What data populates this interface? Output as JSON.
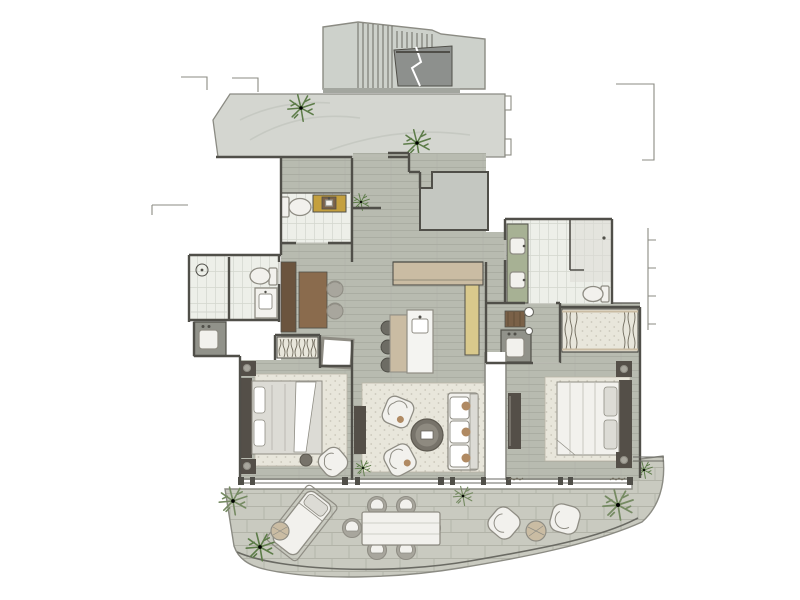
{
  "palette": {
    "paper": "#ffffff",
    "wall": "#504f49",
    "wall_light": "#8b8b83",
    "lintel": "#bdbdb5",
    "corridor": "#d4d6d0",
    "corridor_line": "#c2c5be",
    "stair": "#cdd1cb",
    "landing": "#8d908d",
    "utility": "#c4c7c1",
    "wood_floor": "#b8bbb0",
    "wood_line": "#a6a99e",
    "tile": "#edefe9",
    "tile_line": "#d3d6ce",
    "paver": "#c9cac0",
    "paver_line": "#b2b3a8",
    "rug": "#e8e6db",
    "rug_dot": "#b9b6a7",
    "marble": "#f4f4f1",
    "oak": "#cabca3",
    "vanity_yellow": "#c4a03e",
    "cabinet_yellow": "#d9c98c",
    "vanity_green": "#a7b194",
    "wood_dark": "#6b543e",
    "wood_mid": "#8a6b4d",
    "cab_brown": "#7a6148",
    "furn_white": "#f2f1ed",
    "furn_gray": "#a8a69d",
    "furn_stroke": "#8f8d84",
    "counter_gray": "#91928a",
    "headboard": "#544f48",
    "bed_gray": "#dcdbd5",
    "pillow_tan": "#b08a63",
    "plant": "#5d7c49",
    "plant_gray": "#768b63",
    "squiggle": "#6f6a5c",
    "glass": "#6a6a63",
    "shadow": "#a3a69f"
  },
  "scene": {
    "type": "residential-floor-plan-rendering",
    "rooms": [
      {
        "name": "stairwell",
        "features": [
          "stair-treads",
          "landing",
          "break-line"
        ]
      },
      {
        "name": "access-corridor",
        "features": [
          "stone-floor",
          "two-plants"
        ]
      },
      {
        "name": "entry-hall",
        "features": [
          "wood-floor",
          "plant"
        ]
      },
      {
        "name": "powder-room",
        "features": [
          "toilet",
          "yellow-vanity"
        ]
      },
      {
        "name": "utility-room",
        "features": []
      },
      {
        "name": "guest-bathroom",
        "features": [
          "shower",
          "toilet",
          "vanity",
          "washbasin-nook"
        ]
      },
      {
        "name": "study-nook",
        "features": [
          "console",
          "desk",
          "two-chairs"
        ]
      },
      {
        "name": "kitchen",
        "features": [
          "counter",
          "marble-island",
          "sink",
          "three-stools",
          "tall-yellow-cabinet"
        ]
      },
      {
        "name": "living-room",
        "features": [
          "rug",
          "sofa",
          "two-armchairs",
          "coffee-table",
          "tv-console",
          "plant"
        ]
      },
      {
        "name": "bedroom-left",
        "features": [
          "bed",
          "nightstands",
          "rug",
          "armchair",
          "stool",
          "closet",
          "bench"
        ]
      },
      {
        "name": "master-bathroom",
        "features": [
          "double-green-vanity",
          "walk-in-shower",
          "toilet"
        ]
      },
      {
        "name": "master-vestibule",
        "features": [
          "cabinet",
          "washbasin",
          "door-pivots"
        ]
      },
      {
        "name": "wardrobe",
        "features": [
          "hanging-rails"
        ]
      },
      {
        "name": "bedroom-right",
        "features": [
          "bed",
          "nightstands",
          "rug",
          "tv-console"
        ]
      },
      {
        "name": "terrace",
        "features": [
          "pavers",
          "sun-lounger",
          "side-table",
          "dining-table-six-chairs",
          "two-lounge-chairs",
          "round-table",
          "plants"
        ]
      }
    ]
  }
}
